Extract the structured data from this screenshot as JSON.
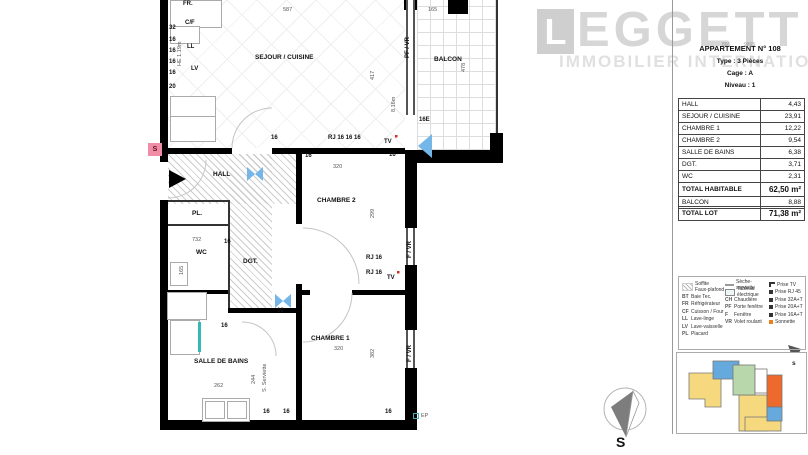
{
  "branding": {
    "logo_initial": "L",
    "logo_text": "EGGETT",
    "logo_sub": "IMMOBILIER INTERNATIONAL",
    "ref_left": "866",
    "ref_right": "9865"
  },
  "header": {
    "title": "APPARTEMENT N° 108",
    "line2": "Type : 3 Pièces",
    "line3": "Cage : A",
    "line4": "Niveau : 1"
  },
  "area_table": {
    "rows": [
      {
        "label": "HALL",
        "value": "4,43"
      },
      {
        "label": "SEJOUR / CUISINE",
        "value": "23,91"
      },
      {
        "label": "CHAMBRE 1",
        "value": "12,22"
      },
      {
        "label": "CHAMBRE 2",
        "value": "9,54"
      },
      {
        "label": "SALLE DE BAINS",
        "value": "6,38"
      },
      {
        "label": "DGT.",
        "value": "3,71"
      },
      {
        "label": "WC",
        "value": "2,31"
      },
      {
        "label": "TOTAL HABITABLE",
        "value": "62,50 m²",
        "bold": true
      },
      {
        "label": "BALCON",
        "value": "8,88"
      }
    ],
    "total_row": {
      "label": "TOTAL LOT",
      "value": "71,38 m²",
      "bold": true
    }
  },
  "legend": {
    "columns": [
      [
        {
          "swatch": "hatch",
          "label": "Soffite\nFaux-plafond",
          "tall": true
        },
        {
          "abbr": "BT",
          "label": "Baie Tec."
        },
        {
          "abbr": "FR",
          "label": "Réfrigérateur"
        },
        {
          "abbr": "CF",
          "label": "Cuisson / Four"
        },
        {
          "abbr": "LL",
          "label": "Lave-linge"
        },
        {
          "abbr": "LV",
          "label": "Lave-vaisselle"
        },
        {
          "abbr": "PL",
          "label": "Placard"
        }
      ],
      [
        {
          "swatch": "line",
          "label": "Sèche-serviette"
        },
        {
          "swatch": "box",
          "label": "Tableau électrique"
        },
        {
          "abbr": "CH",
          "label": "Chaudière"
        },
        {
          "abbr": "PF",
          "label": "Porte fenêtre"
        },
        {
          "abbr": "F",
          "label": "Fenêtre"
        },
        {
          "abbr": "VR",
          "label": "Volet roulant"
        }
      ],
      [
        {
          "icon": "tv",
          "label": "Prise TV"
        },
        {
          "icon": "rj45",
          "label": "Prise RJ 45"
        },
        {
          "icon": "socket",
          "label": "Prise 32A+T"
        },
        {
          "icon": "socket",
          "label": "Prise 20A+T"
        },
        {
          "icon": "socket",
          "label": "Prise 16A+T"
        },
        {
          "icon": "sonnette",
          "label": "Sonnette"
        }
      ]
    ]
  },
  "compass": {
    "south_label": "S",
    "mini_south_label": "s"
  },
  "plan": {
    "entry_bell": "S",
    "colors": {
      "bell_pink": "#f08ca6",
      "light_blue": "#74b6e8",
      "teal": "#35b8b8",
      "sonnette_orange": "#e8821e",
      "tv_red": "#d03020"
    },
    "labels": [
      {
        "t": "FR.",
        "x": 183,
        "y": 1,
        "v": "sock"
      },
      {
        "t": "C/F",
        "x": 185,
        "y": 20,
        "v": "sock"
      },
      {
        "t": "32",
        "x": 169,
        "y": 25,
        "v": "sock"
      },
      {
        "t": "16",
        "x": 169,
        "y": 37,
        "v": "sock"
      },
      {
        "t": "LL",
        "x": 187,
        "y": 44,
        "v": "sock"
      },
      {
        "t": "16",
        "x": 169,
        "y": 48,
        "v": "sock"
      },
      {
        "t": "HE 1.19m",
        "x": 178,
        "y": 66,
        "v": "dim",
        "r": true
      },
      {
        "t": "16",
        "x": 169,
        "y": 59,
        "v": "sock"
      },
      {
        "t": "LV",
        "x": 191,
        "y": 66,
        "v": "sock"
      },
      {
        "t": "16",
        "x": 169,
        "y": 70,
        "v": "sock"
      },
      {
        "t": "20",
        "x": 169,
        "y": 84,
        "v": "sock"
      },
      {
        "t": "587",
        "x": 283,
        "y": 8,
        "v": "dim"
      },
      {
        "t": "165",
        "x": 428,
        "y": 8,
        "v": "dim"
      },
      {
        "t": "SEJOUR / CUISINE",
        "x": 255,
        "y": 55,
        "v": "room"
      },
      {
        "t": "417",
        "x": 371,
        "y": 80,
        "v": "dim",
        "r": true
      },
      {
        "t": "PF / VR",
        "x": 405,
        "y": 58,
        "v": "sock",
        "r": true
      },
      {
        "t": "8.16m",
        "x": 392,
        "y": 112,
        "v": "dim",
        "r": true
      },
      {
        "t": "BALCON",
        "x": 434,
        "y": 57,
        "v": "room"
      },
      {
        "t": "478",
        "x": 462,
        "y": 72,
        "v": "dim",
        "r": true
      },
      {
        "t": "16E",
        "x": 419,
        "y": 117,
        "v": "sock"
      },
      {
        "t": "16",
        "x": 271,
        "y": 135,
        "v": "sock"
      },
      {
        "t": "RJ 16 16 16",
        "x": 328,
        "y": 135,
        "v": "sock"
      },
      {
        "t": "TV",
        "x": 384,
        "y": 139,
        "v": "sock"
      },
      {
        "t": "16",
        "x": 305,
        "y": 153,
        "v": "sock"
      },
      {
        "t": "16",
        "x": 389,
        "y": 152,
        "v": "sock"
      },
      {
        "t": "HALL",
        "x": 213,
        "y": 172,
        "v": "room"
      },
      {
        "t": "320",
        "x": 333,
        "y": 165,
        "v": "dim"
      },
      {
        "t": "CHAMBRE 2",
        "x": 317,
        "y": 198,
        "v": "room"
      },
      {
        "t": "299",
        "x": 371,
        "y": 218,
        "v": "dim",
        "r": true
      },
      {
        "t": "PL.",
        "x": 192,
        "y": 211,
        "v": "room"
      },
      {
        "t": "732",
        "x": 192,
        "y": 238,
        "v": "dim"
      },
      {
        "t": "16",
        "x": 224,
        "y": 239,
        "v": "sock"
      },
      {
        "t": "WC",
        "x": 196,
        "y": 250,
        "v": "room"
      },
      {
        "t": "165",
        "x": 180,
        "y": 275,
        "v": "dim",
        "r": true
      },
      {
        "t": "DGT.",
        "x": 243,
        "y": 259,
        "v": "room"
      },
      {
        "t": "RJ 16",
        "x": 366,
        "y": 255,
        "v": "sock"
      },
      {
        "t": "RJ 16",
        "x": 366,
        "y": 270,
        "v": "sock"
      },
      {
        "t": "TV",
        "x": 387,
        "y": 275,
        "v": "sock"
      },
      {
        "t": "F / VR",
        "x": 407,
        "y": 258,
        "v": "sock",
        "r": true
      },
      {
        "t": "F / VR",
        "x": 407,
        "y": 362,
        "v": "sock",
        "r": true
      },
      {
        "t": "16",
        "x": 277,
        "y": 308,
        "v": "sock"
      },
      {
        "t": "16",
        "x": 221,
        "y": 323,
        "v": "sock"
      },
      {
        "t": "CHAMBRE 1",
        "x": 311,
        "y": 336,
        "v": "room"
      },
      {
        "t": "320",
        "x": 334,
        "y": 347,
        "v": "dim"
      },
      {
        "t": "382",
        "x": 371,
        "y": 358,
        "v": "dim",
        "r": true
      },
      {
        "t": "SALLE DE BAINS",
        "x": 194,
        "y": 359,
        "v": "room"
      },
      {
        "t": "244",
        "x": 252,
        "y": 384,
        "v": "dim",
        "r": true
      },
      {
        "t": "S. Serviette",
        "x": 263,
        "y": 392,
        "v": "dim",
        "r": true
      },
      {
        "t": "262",
        "x": 214,
        "y": 384,
        "v": "dim"
      },
      {
        "t": "16",
        "x": 263,
        "y": 409,
        "v": "sock"
      },
      {
        "t": "16",
        "x": 283,
        "y": 409,
        "v": "sock"
      },
      {
        "t": "16",
        "x": 385,
        "y": 409,
        "v": "sock"
      },
      {
        "t": "EP",
        "x": 421,
        "y": 414,
        "v": "dim"
      }
    ]
  },
  "keyplan_colors": {
    "yellow": "#f6d97e",
    "blue": "#66a9dc",
    "green": "#b8d8ac",
    "orange": "#ed6a2c"
  }
}
